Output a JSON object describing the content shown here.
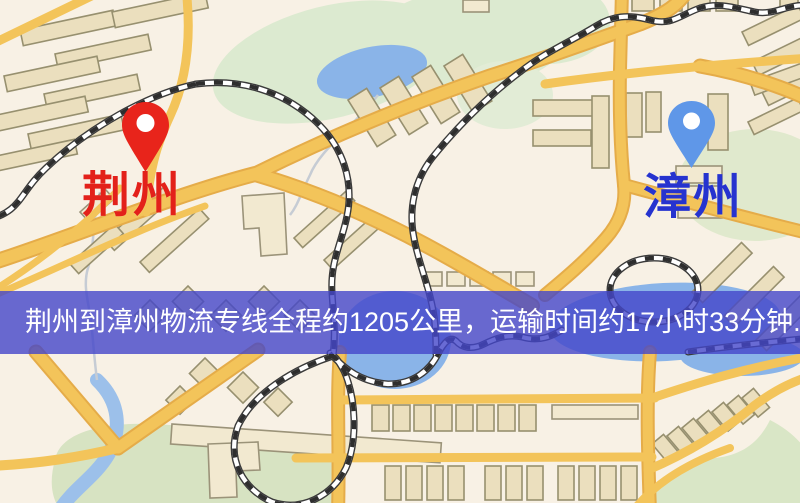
{
  "page": {
    "type": "logistics-route-map-screenshot"
  },
  "map": {
    "origin": {
      "name": "荆州",
      "pin_color": "#e8241b",
      "label_color": "#e3211a"
    },
    "destination": {
      "name": "漳州",
      "pin_color": "#5f97e8",
      "label_color": "#2633cf"
    },
    "palette": {
      "background": "#f8f1e5",
      "road": "#f3c45a",
      "road_casing": "#e5ac49",
      "building_fill": "#ebdfbe",
      "building_stroke": "#97906f",
      "green_area": "#dcead0",
      "water": "#8ab4e8",
      "railway_dark": "#2e2e2e"
    }
  },
  "banner": {
    "text": "荆州到漳州物流专线全程约1205公里，运输时间约17小时33分钟.",
    "overlay_color": "rgba(67,70,201,0.8)",
    "text_color": "#ffffff"
  }
}
